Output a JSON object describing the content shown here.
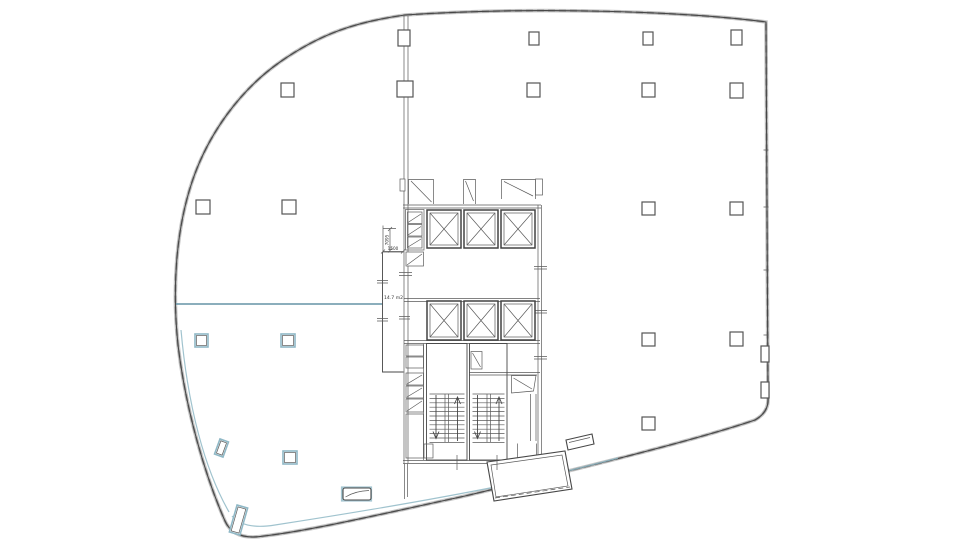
{
  "document": {
    "title": "floor-plan",
    "type": "architectural floor plan drawing",
    "background": "#ffffff"
  },
  "labels": {
    "room_area": "14.7 m2",
    "dim_vertical": "7095",
    "dim_horizontal": "1500"
  },
  "colors": {
    "line_dark": "#474747",
    "line_medium": "#9c9c9c",
    "wall_band": "#c7c7c7",
    "accent_teal": "#8fb8c6",
    "divider_teal": "#6593a6",
    "fill_white": "#ffffff"
  },
  "features": {
    "elevator_shafts_upper": 3,
    "elevator_shafts_lower": 3,
    "stairwells": 2,
    "vestibule_doors": 3,
    "columns_dark": 18,
    "columns_teal": 3,
    "tilted_teal_elements": 2,
    "benches": 2,
    "entrance_vestibule": 1
  }
}
